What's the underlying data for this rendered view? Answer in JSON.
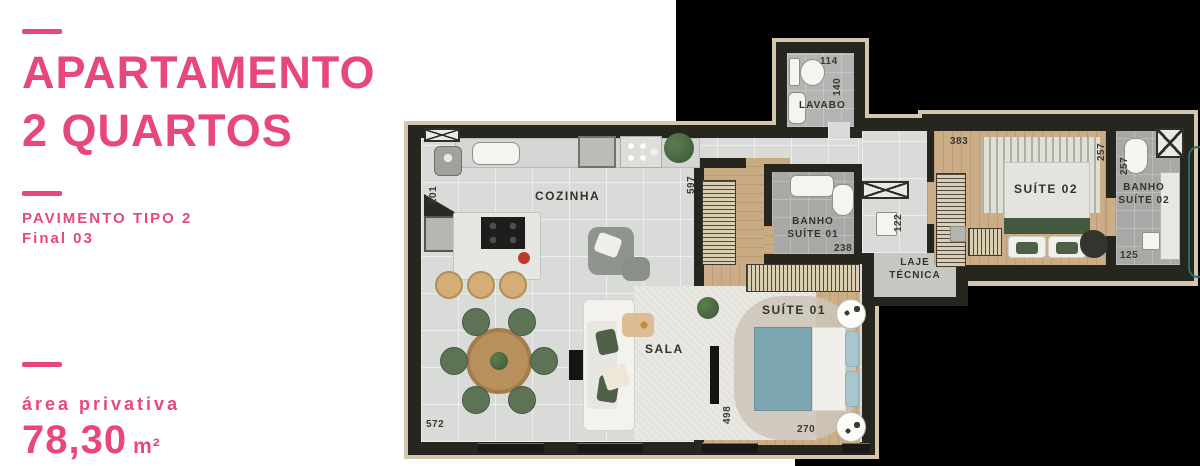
{
  "panel": {
    "title_line1": "APARTAMENTO",
    "title_line2": "2 QUARTOS",
    "floor_label": "PAVIMENTO TIPO 2",
    "unit_label": "Final 03",
    "area_label": "área privativa",
    "area_value": "78,30",
    "area_unit": "m²"
  },
  "colors": {
    "accent": "#E7467F",
    "backdrop": "#000000",
    "wall": "#26261F",
    "wood_floor": "#CBAE87",
    "tile_floor": "#D9DBD8"
  },
  "floorplan": {
    "rooms": {
      "cozinha": "COZINHA",
      "sala": "SALA",
      "lavabo": "LAVABO",
      "suite01": "SUÍTE 01",
      "suite02": "SUÍTE 02",
      "banho1_line1": "BANHO",
      "banho1_line2": "SUÍTE 01",
      "banho2_line1": "BANHO",
      "banho2_line2": "SUÍTE 02",
      "laje_line1": "LAJE",
      "laje_line2": "TÉCNICA"
    },
    "dims": {
      "lavabo_width": "114",
      "lavabo_depth": "140",
      "kitchen_left": "201",
      "hall_left": "597",
      "sala_width": "572",
      "banho1_width": "238",
      "hall_width": "122",
      "suite01_depth": "498",
      "suite01_width": "270",
      "suite02_width": "383",
      "suite02_depth": "257",
      "banho2_depth": "257",
      "banho2_width": "125"
    }
  }
}
